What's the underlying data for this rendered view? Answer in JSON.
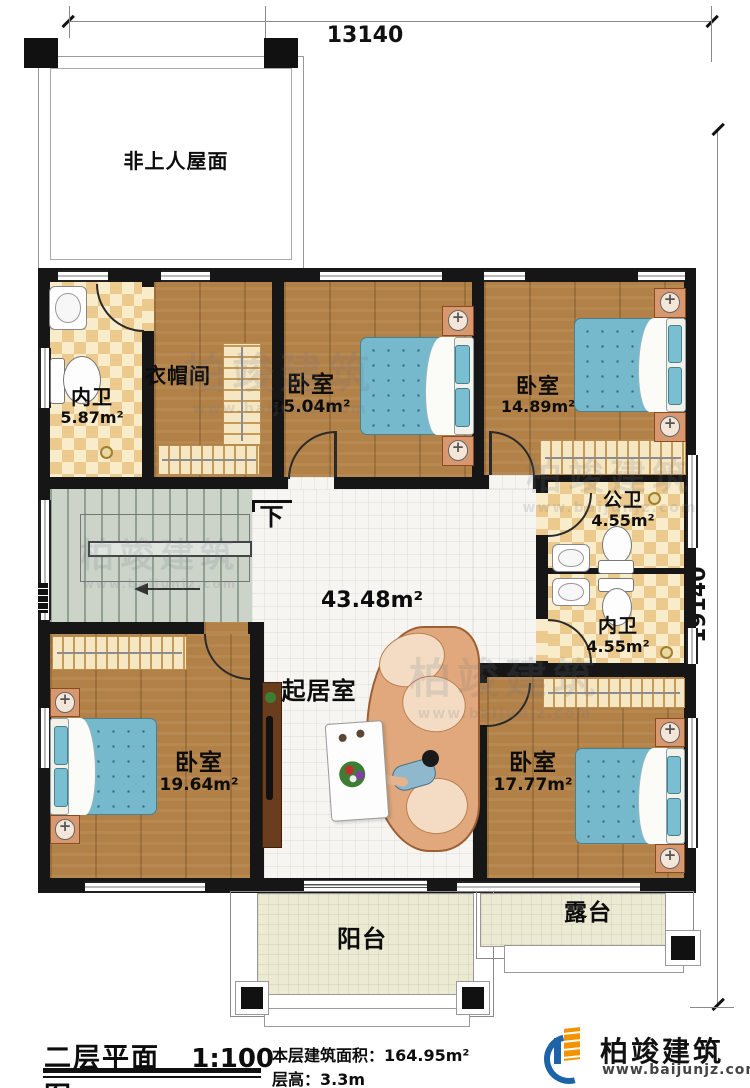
{
  "dimensions": {
    "top": "13140",
    "right": "19140"
  },
  "rooms": {
    "roof": {
      "name": "非上人屋面"
    },
    "bath_top_left": {
      "name": "内卫",
      "area": "5.87m²"
    },
    "cloakroom": {
      "name": "衣帽间"
    },
    "bedroom_top": {
      "name": "卧室",
      "area": "25.04m²"
    },
    "bedroom_top_right": {
      "name": "卧室",
      "area": "14.89m²"
    },
    "bath_public": {
      "name": "公卫",
      "area": "4.55m²"
    },
    "bath_ensuite": {
      "name": "内卫",
      "area": "4.55m²"
    },
    "living": {
      "name": "起居室",
      "area": "43.48m²"
    },
    "bedroom_left": {
      "name": "卧室",
      "area": "19.64m²"
    },
    "bedroom_right": {
      "name": "卧室",
      "area": "17.77m²"
    },
    "balcony": {
      "name": "阳台"
    },
    "terrace": {
      "name": "露台"
    }
  },
  "stairs": {
    "direction_label": "下"
  },
  "titlebar": {
    "drawing_title": "二层平面图",
    "scale": "1:100",
    "floor_area_label": "本层建筑面积：",
    "floor_area_value": "164.95m²",
    "floor_height_label": "层高：",
    "floor_height_value": "3.3m"
  },
  "brand": {
    "name": "柏竣建筑",
    "website": "www.baijunjz.com"
  },
  "watermark": {
    "line1": "柏竣建筑",
    "line2": "www.baijunjz.com"
  },
  "colors": {
    "wall": "#161616",
    "wood_floor": "#b28147",
    "tile_floor": "#f6f5f1",
    "checker_dark": "#ecca8d",
    "checker_light": "#f9ecca",
    "stairs": "#ccd4ca",
    "balcony_floor": "#edead3",
    "bed_blue": "#76b9cc",
    "sofa_tan": "#e0a87c",
    "brand_blue": "#1e63a8",
    "brand_orange": "#f29400"
  }
}
